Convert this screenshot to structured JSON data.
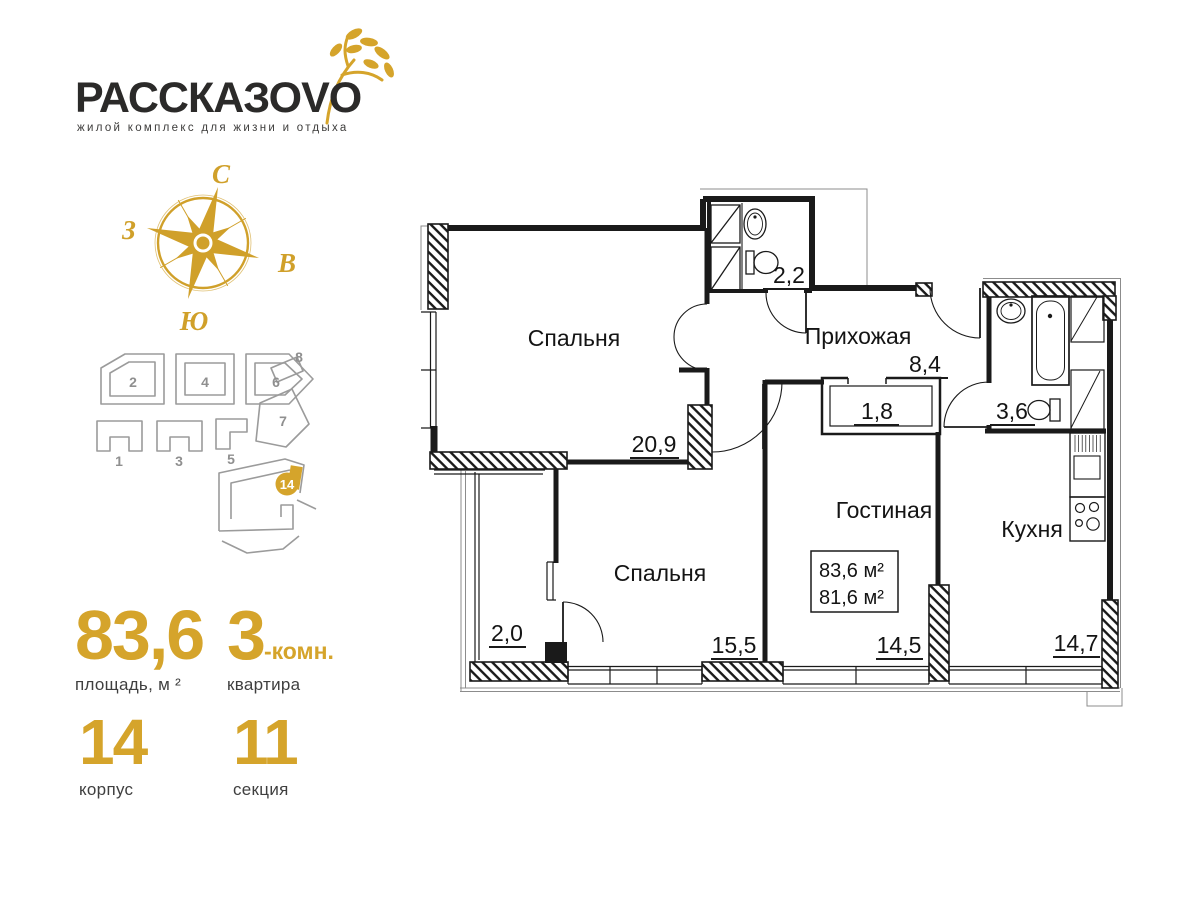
{
  "logo": {
    "title": "РАССКАЗОVO",
    "tagline": "жилой комплекс для жизни и отдыха"
  },
  "compass": {
    "north": "С",
    "east": "В",
    "south": "Ю",
    "west": "З"
  },
  "site_plan": {
    "building_numbers": [
      "1",
      "2",
      "3",
      "4",
      "5",
      "6",
      "7",
      "8"
    ],
    "current_building": "14"
  },
  "stats": {
    "area_value": "83,6",
    "area_label": "площадь, м ²",
    "rooms_value": "3",
    "rooms_suffix": "-комн.",
    "rooms_label": "квартира",
    "korpus_value": "14",
    "korpus_label": "корпус",
    "section_value": "11",
    "section_label": "секция"
  },
  "floor_plan": {
    "rooms": [
      {
        "name": "Спальня",
        "area": "20,9"
      },
      {
        "name": "Прихожая",
        "area": "8,4"
      },
      {
        "name": "Гостиная",
        "area": "14,5"
      },
      {
        "name": "Спальня",
        "area": "15,5"
      },
      {
        "name": "Кухня",
        "area": "14,7"
      }
    ],
    "unlabeled_areas": [
      "2,2",
      "3,6",
      "1,8",
      "2,0"
    ],
    "info_box": {
      "total_area": "83,6 м²",
      "living_area": "81,6 м²"
    }
  },
  "colors": {
    "accent_gold": "#d5a42b",
    "plan_line": "#1a1a1a",
    "site_gray": "#9b9b9b"
  }
}
